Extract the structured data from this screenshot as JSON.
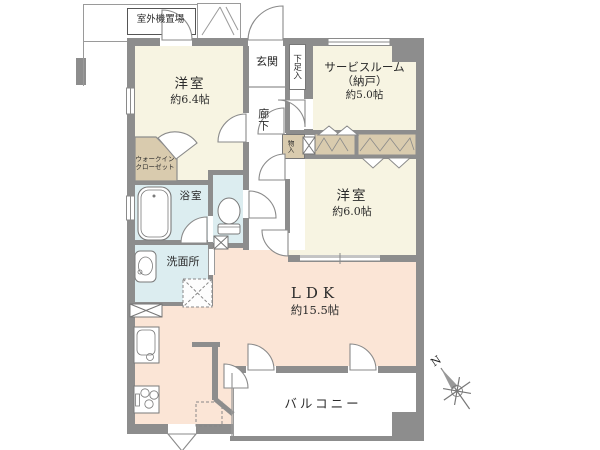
{
  "colors": {
    "wall": "#8d8d8d",
    "room_cream": "#f7f4e2",
    "ldk_peach": "#fbe5d6",
    "wet_blue": "#dcedf0",
    "closet_tan": "#d9cbae",
    "balcony_white": "#ffffff"
  },
  "rooms": {
    "western_room_1": {
      "name": "洋室",
      "size": "約6.4帖"
    },
    "service_room": {
      "line1": "サービスルーム",
      "line2": "（納戸）",
      "size": "約5.0帖"
    },
    "western_room_2": {
      "name": "洋室",
      "size": "約6.0帖"
    },
    "ldk": {
      "name": "LDK",
      "size": "約15.5帖"
    },
    "balcony": {
      "name": "バルコニー"
    },
    "entrance": {
      "name": "玄関"
    },
    "shoe_box": {
      "name": "下足入"
    },
    "hallway": {
      "name": "廊下"
    },
    "walk_in_closet": {
      "line1": "ウォークイン",
      "line2": "クローゼット"
    },
    "bathroom": {
      "name": "浴室"
    },
    "washroom": {
      "name": "洗面所"
    },
    "storage": {
      "name": "物入"
    },
    "outdoor_unit_space": {
      "name": "室外機置場"
    }
  },
  "compass": {
    "north_label": "N"
  }
}
